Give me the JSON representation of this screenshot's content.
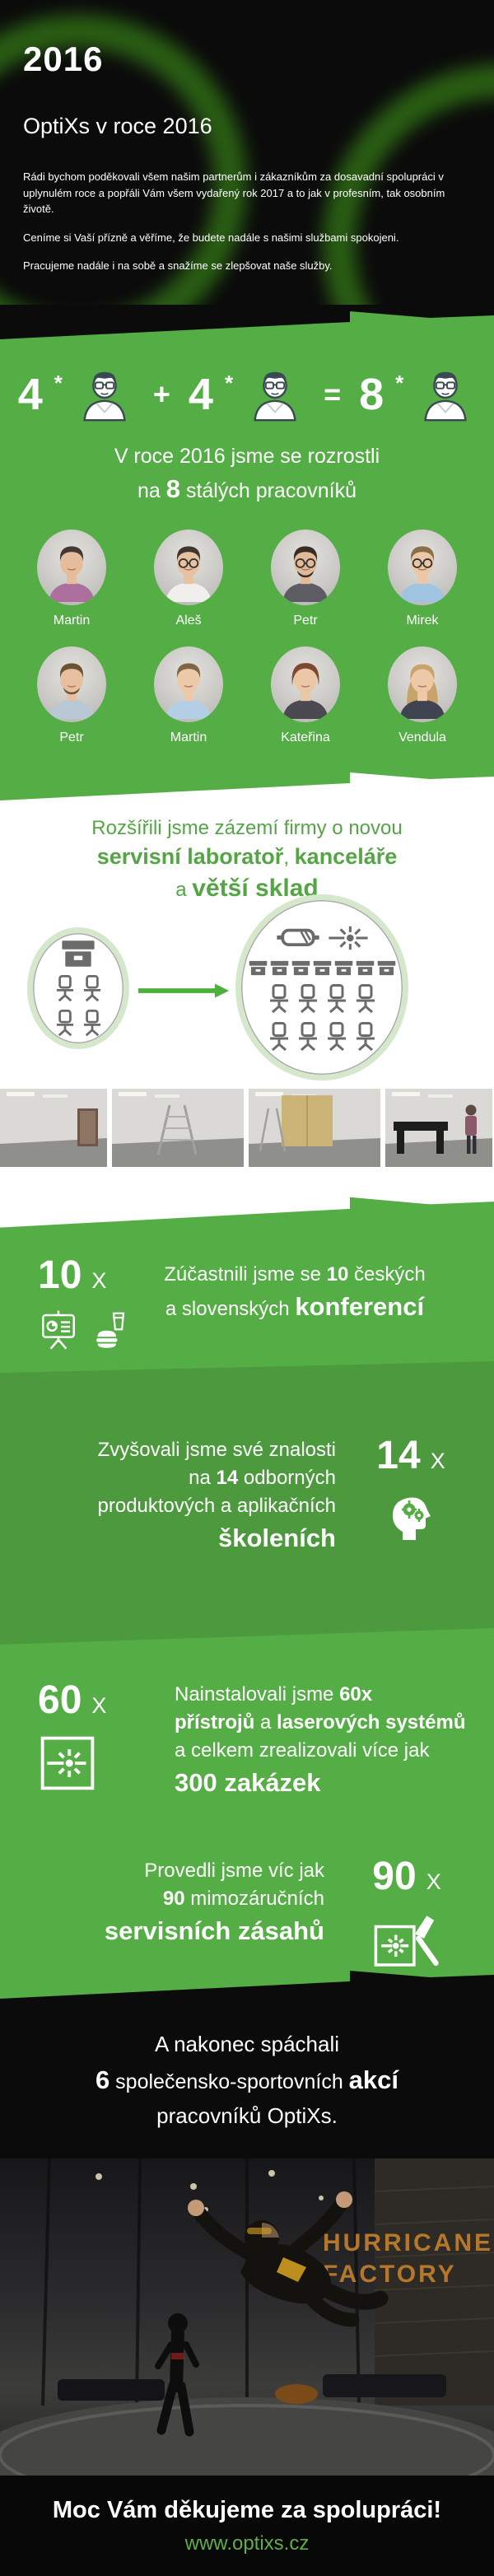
{
  "colors": {
    "green": "#55ad45",
    "heading_green": "#55a546",
    "link_green": "#5fae46",
    "black": "#0b0b0b",
    "white": "#ffffff",
    "icon_gray": "#6b6b6b",
    "circle_ring": "#d5e8cc",
    "arrow_green": "#4caf3e",
    "sign_orange": "#b5772b"
  },
  "header": {
    "year": "2016",
    "title": "OptiXs v roce 2016",
    "paragraphs": [
      "Rádi bychom poděkovali všem našim partnerům i zákazníkům za dosavadní spolupráci v uplynulém roce a popřáli Vám všem vydařený rok 2017 a to jak v profesním, tak osobním životě.",
      "Ceníme si Vaší přízně a věříme, že budete nadále s našimi službami spokojeni.",
      "Pracujeme nadále i na sobě a snažíme se zlepšovat naše služby."
    ]
  },
  "growth": {
    "equation": {
      "a": "4",
      "star": "*",
      "plus": "+",
      "b": "4",
      "equals": "=",
      "result": "8"
    },
    "heading_line1": "V roce 2016 jsme se rozrostli",
    "heading_line2": [
      {
        "t": "na "
      },
      {
        "t": "8",
        "b": true
      },
      {
        "t": " stálých pracovníků"
      }
    ]
  },
  "team": {
    "members": [
      {
        "name": "Martin",
        "shirt": "#ad6f9e",
        "hair": "#453830",
        "skin": "#e5bd9c",
        "glasses": false,
        "beard": false,
        "female": false,
        "long_hair": false
      },
      {
        "name": "Aleš",
        "shirt": "#f0efec",
        "hair": "#3e352d",
        "skin": "#e8c2a0",
        "glasses": true,
        "beard": false,
        "female": false,
        "long_hair": false
      },
      {
        "name": "Petr",
        "shirt": "#5c5c62",
        "hair": "#362d26",
        "skin": "#e3ba98",
        "glasses": true,
        "beard": true,
        "female": false,
        "long_hair": false
      },
      {
        "name": "Mirek",
        "shirt": "#9ec4e2",
        "hair": "#8a6e4c",
        "skin": "#ecc7a6",
        "glasses": true,
        "beard": false,
        "female": false,
        "long_hair": false
      },
      {
        "name": "Petr",
        "shirt": "#b8c8d4",
        "hair": "#6d5335",
        "skin": "#e6bf9e",
        "glasses": false,
        "beard": true,
        "female": false,
        "long_hair": false
      },
      {
        "name": "Martin",
        "shirt": "#b4cee6",
        "hair": "#7e6644",
        "skin": "#ecc9a8",
        "glasses": false,
        "beard": false,
        "female": false,
        "long_hair": false
      },
      {
        "name": "Kateřina",
        "shirt": "#4a4a50",
        "hair": "#7c4a32",
        "skin": "#ecc7a6",
        "glasses": false,
        "beard": false,
        "female": true,
        "long_hair": false
      },
      {
        "name": "Vendula",
        "shirt": "#3f4450",
        "hair": "#c9a46a",
        "skin": "#eec9a8",
        "glasses": false,
        "beard": false,
        "female": true,
        "long_hair": true
      }
    ]
  },
  "expansion": {
    "heading_line1": "Rozšířili jsme zázemí firmy o novou",
    "heading_line2": [
      {
        "t": "servisní laboratoř",
        "b": true
      },
      {
        "t": ", "
      },
      {
        "t": "kanceláře",
        "b": true
      }
    ],
    "heading_line3": [
      {
        "t": "a "
      },
      {
        "t": "větší sklad",
        "big": true
      }
    ],
    "before": {
      "desks": 1,
      "chairs": 4
    },
    "after": {
      "goggles": 1,
      "lasers": 1,
      "desks": 7,
      "chairs": 8
    },
    "photos": [
      "empty-room",
      "room-with-ladders",
      "construction-wall",
      "optical-table-move"
    ]
  },
  "stats": [
    {
      "id": "conferences",
      "count": "10",
      "x": "X",
      "icons": [
        "presentation-icon",
        "catering-icon"
      ],
      "lines": [
        [
          {
            "t": "Zúčastnili jsme se "
          },
          {
            "t": "10",
            "b": true
          },
          {
            "t": " českých"
          }
        ],
        [
          {
            "t": "a slovenských "
          },
          {
            "t": "konferencí",
            "big": true
          }
        ]
      ]
    },
    {
      "id": "trainings",
      "count": "14",
      "x": "X",
      "icons": [
        "knowledge-head-icon"
      ],
      "lines": [
        [
          {
            "t": "Zvyšovali jsme své znalosti"
          }
        ],
        [
          {
            "t": "na "
          },
          {
            "t": "14",
            "b": true
          },
          {
            "t": " odborných"
          }
        ],
        [
          {
            "t": "produktových a aplikačních"
          }
        ],
        [
          {
            "t": "školeních",
            "big": true
          }
        ]
      ]
    },
    {
      "id": "installations",
      "count": "60",
      "x": "X",
      "icons": [
        "laser-box-icon"
      ],
      "lines": [
        [
          {
            "t": "Nainstalovali jsme "
          },
          {
            "t": "60x",
            "b": true
          }
        ],
        [
          {
            "t": "přístrojů",
            "b": true
          },
          {
            "t": " a "
          },
          {
            "t": "laserových systémů",
            "b": true
          }
        ],
        [
          {
            "t": "a celkem zrealizovali více jak"
          }
        ],
        [
          {
            "t": "300 zakázek",
            "big": true
          }
        ]
      ]
    },
    {
      "id": "service",
      "count": "90",
      "x": "X",
      "icons": [
        "service-tool-icon"
      ],
      "lines": [
        [
          {
            "t": "Provedli jsme víc jak"
          }
        ],
        [
          {
            "t": "90",
            "b": true
          },
          {
            "t": " mimozáručních"
          }
        ],
        [
          {
            "t": "servisních zásahů",
            "big": true
          }
        ]
      ]
    }
  ],
  "finale": {
    "line1": "A nakonec spáchali",
    "line2": [
      {
        "t": "6",
        "b": true
      },
      {
        "t": " společensko-sportovních "
      },
      {
        "t": "akcí",
        "b": true
      }
    ],
    "line3": "pracovníků OptiXs."
  },
  "event_photo": {
    "sign_line1": "HURRICANE",
    "sign_line2": "FACTORY"
  },
  "footer": {
    "message": "Moc Vám děkujeme za spolupráci!",
    "website": "www.optixs.cz"
  }
}
